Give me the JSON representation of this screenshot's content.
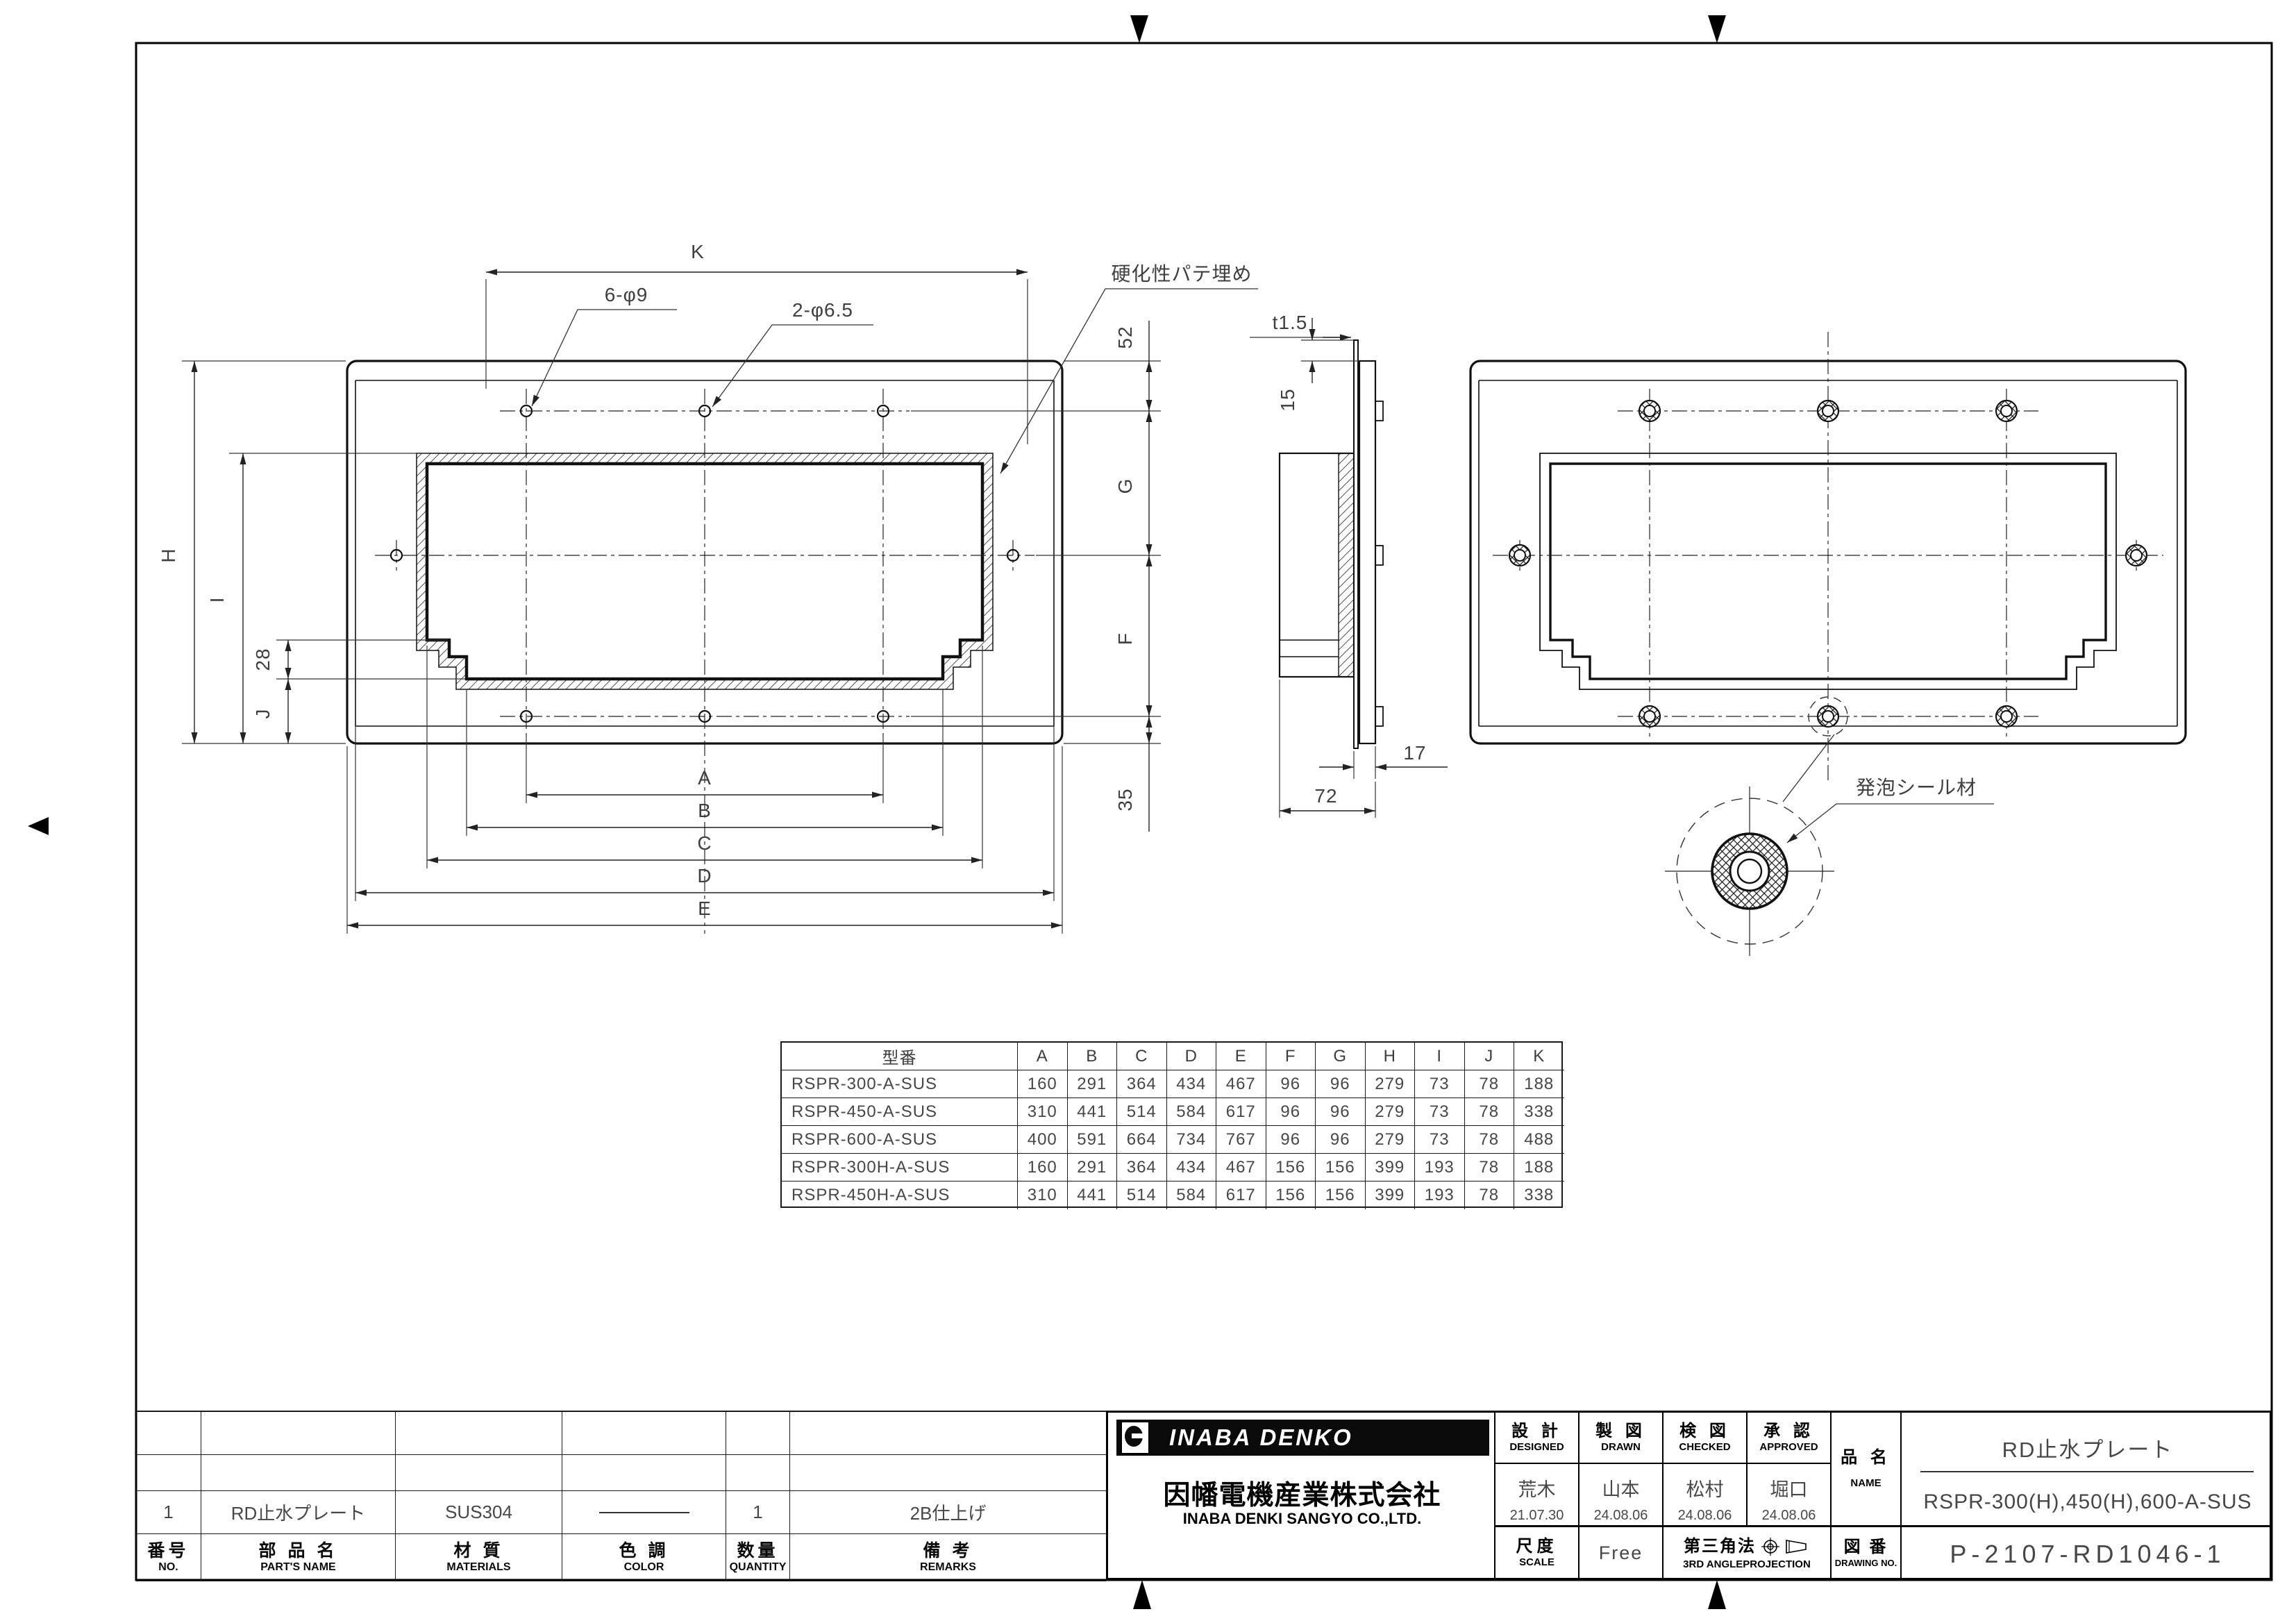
{
  "drawing": {
    "front": {
      "k": "K",
      "holes_outer": "6-φ9",
      "holes_side": "2-φ6.5",
      "putty": "硬化性パテ埋め",
      "d52": "52",
      "g": "G",
      "f": "F",
      "d35": "35",
      "h": "H",
      "i": "I",
      "d28": "28",
      "j": "J",
      "a": "A",
      "b": "B",
      "c": "C",
      "d": "D",
      "e": "E"
    },
    "side": {
      "t": "t1.5",
      "d15": "15",
      "d17": "17",
      "d72": "72"
    },
    "rear": {
      "seal": "発泡シール材"
    }
  },
  "dim_table": {
    "header": [
      "型番",
      "A",
      "B",
      "C",
      "D",
      "E",
      "F",
      "G",
      "H",
      "I",
      "J",
      "K"
    ],
    "rows": [
      [
        "RSPR-300-A-SUS",
        "160",
        "291",
        "364",
        "434",
        "467",
        "96",
        "96",
        "279",
        "73",
        "78",
        "188"
      ],
      [
        "RSPR-450-A-SUS",
        "310",
        "441",
        "514",
        "584",
        "617",
        "96",
        "96",
        "279",
        "73",
        "78",
        "338"
      ],
      [
        "RSPR-600-A-SUS",
        "400",
        "591",
        "664",
        "734",
        "767",
        "96",
        "96",
        "279",
        "73",
        "78",
        "488"
      ],
      [
        "RSPR-300H-A-SUS",
        "160",
        "291",
        "364",
        "434",
        "467",
        "156",
        "156",
        "399",
        "193",
        "78",
        "188"
      ],
      [
        "RSPR-450H-A-SUS",
        "310",
        "441",
        "514",
        "584",
        "617",
        "156",
        "156",
        "399",
        "193",
        "78",
        "338"
      ]
    ]
  },
  "parts_table": {
    "row": {
      "no": "1",
      "name": "RD止水プレート",
      "material": "SUS304",
      "qty": "1",
      "remarks": "2B仕上げ"
    },
    "header": {
      "no_jp": "番号",
      "no_en": "NO.",
      "name_jp": "部 品 名",
      "name_en": "PART'S NAME",
      "mat_jp": "材 質",
      "mat_en": "MATERIALS",
      "color_jp": "色 調",
      "color_en": "COLOR",
      "qty_jp": "数量",
      "qty_en": "QUANTITY",
      "rem_jp": "備 考",
      "rem_en": "REMARKS"
    }
  },
  "title_block": {
    "brand": "INABA DENKO",
    "company_jp": "因幡電機産業株式会社",
    "company_en": "INABA DENKI SANGYO CO.,LTD.",
    "cols": [
      {
        "jp": "設 計",
        "en": "DESIGNED",
        "name": "荒木",
        "date": "21.07.30"
      },
      {
        "jp": "製 図",
        "en": "DRAWN",
        "name": "山本",
        "date": "24.08.06"
      },
      {
        "jp": "検 図",
        "en": "CHECKED",
        "name": "松村",
        "date": "24.08.06"
      },
      {
        "jp": "承 認",
        "en": "APPROVED",
        "name": "堀口",
        "date": "24.08.06"
      }
    ],
    "name_jp": "品 名",
    "name_en": "NAME",
    "product": "RD止水プレート",
    "model": "RSPR-300(H),450(H),600-A-SUS",
    "scale_jp": "尺度",
    "scale_en": "SCALE",
    "scale_val": "Free",
    "proj_jp": "第三角法",
    "proj_en": "3RD ANGLEPROJECTION",
    "dwg_jp": "図 番",
    "dwg_en": "DRAWING NO.",
    "dwg_no": "P-2107-RD1046-1"
  }
}
